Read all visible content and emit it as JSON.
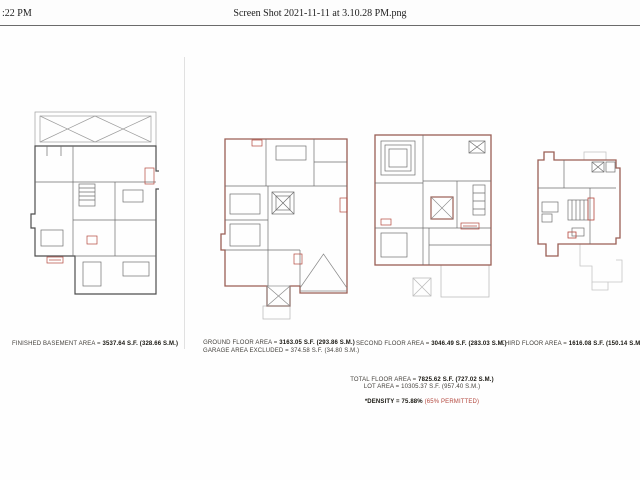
{
  "header": {
    "time": ":22 PM",
    "filename": "Screen Shot 2021-11-11 at 3.10.28 PM.png"
  },
  "plans": [
    {
      "id": "basement",
      "label_prefix": "FINISHED BASEMENT AREA = ",
      "label_value": "3537.64 S.F. (328.66 S.M.)"
    },
    {
      "id": "ground",
      "label_prefix": "GROUND FLOOR AREA = ",
      "label_value": "3163.05 S.F. (293.86 S.M.)",
      "label2_prefix": "GARAGE AREA EXCLUDED = ",
      "label2_value": "374.58 S.F. (34.80 S.M.)"
    },
    {
      "id": "second",
      "label_prefix": "SECOND FLOOR AREA = ",
      "label_value": "3046.49 S.F. (283.03 S.M.)"
    },
    {
      "id": "third",
      "label_prefix": "THIRD FLOOR AREA = ",
      "label_value": "1616.08 S.F. (150.14 S.M.)"
    }
  ],
  "totals": {
    "total_prefix": "TOTAL FLOOR AREA = ",
    "total_value": "7825.62 S.F. (727.02 S.M.)",
    "lot_prefix": "LOT AREA = ",
    "lot_value": "10305.37 S.F. (957.40 S.M.)",
    "density_value": "*DENSITY = 75.88%",
    "density_note": " (65% PERMITTED)"
  },
  "colors": {
    "accent_red": "#b3473d",
    "plan_wall_red": "#9a5f55",
    "plan_line_gray": "#6e6e6e",
    "roof_gray": "#c5c5c5"
  }
}
